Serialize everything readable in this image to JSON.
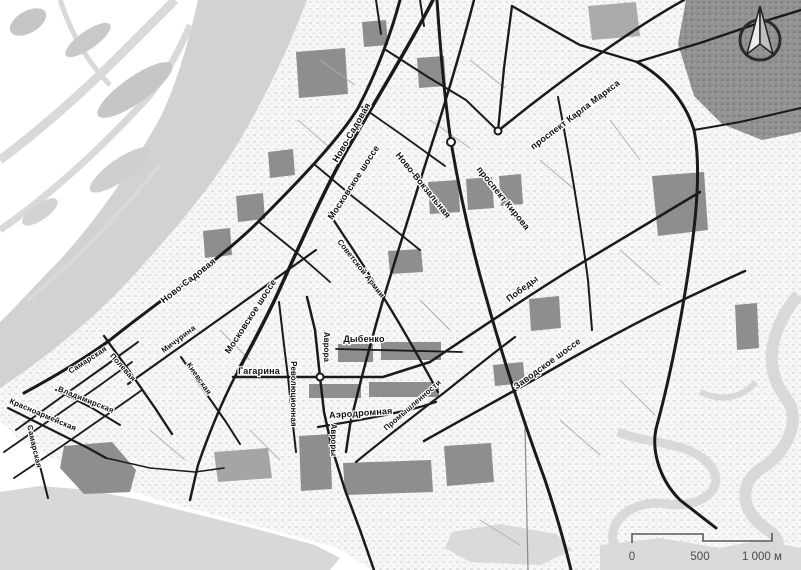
{
  "map": {
    "street_labels": [
      "Ново-Садовая",
      "Московское шоссе",
      "Ново-Вокзальная",
      "проспект Кирова",
      "проспект Карла Маркса",
      "Ново-Садовая",
      "Московское шоссе",
      "Советской Армии",
      "Мичурина",
      "Полевая",
      "Самарская",
      "Киевская",
      "Владимирская",
      "Красноармейская",
      "Самарская",
      "Гагарина",
      "Революционная",
      "Аврора",
      "Дыбенко",
      "Авроры",
      "Аэродромная",
      "Промышленности",
      "Победы",
      "Заводское шоссе"
    ],
    "scale_bar": {
      "ticks": [
        "0",
        "500",
        "1 000 м"
      ]
    },
    "icons": {
      "compass": "north-arrow-compass"
    },
    "colors": {
      "water": "#d2d2d2",
      "road": "#1a1a1a",
      "building_block": "#8e8e8e",
      "urban_fill": "#f4f4f3",
      "label_text": "#101010"
    }
  }
}
